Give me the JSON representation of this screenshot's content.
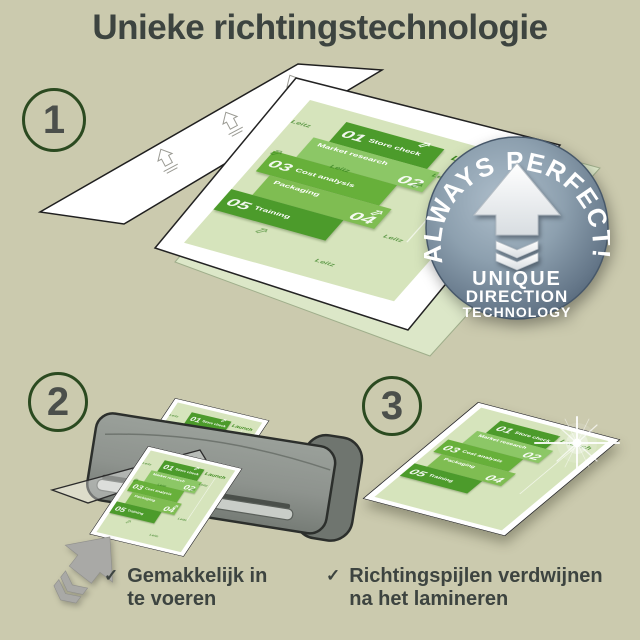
{
  "title": "Unieke richtingstechnologie",
  "steps": {
    "one": "1",
    "two": "2",
    "three": "3"
  },
  "badge": {
    "arc_text": "ALWAYS PERFECT!",
    "line1": "UNIQUE",
    "line2": "DIRECTION",
    "line3": "TECHNOLOGY"
  },
  "doc": {
    "launch_label": "Launch",
    "watermark_brand": "Leitz",
    "arrow_glyph": "⇧",
    "items": [
      {
        "num": "01",
        "label": "Store check"
      },
      {
        "num": "02",
        "label": "Market research"
      },
      {
        "num": "03",
        "label": "Cost analysis"
      },
      {
        "num": "04",
        "label": "Packaging"
      },
      {
        "num": "05",
        "label": "Training"
      }
    ]
  },
  "bullets": [
    {
      "check": "✓",
      "line1": "Gemakkelijk in",
      "line2": "te voeren"
    },
    {
      "check": "✓",
      "line1": "Richtingspijlen verdwijnen",
      "line2": "na het lamineren"
    }
  ],
  "colors": {
    "background": "#cbcaae",
    "ink": "#3d4440",
    "circle_ring": "#2b4a20",
    "green_dark": "#4c9b2b",
    "green_mid": "#67b03a",
    "green_light": "#8cc766",
    "green_light2": "#7fbd52",
    "page_green": "#d6e4bc",
    "launch_green": "#3e8a1e",
    "badge_steel": "#7e93a4",
    "machine_gray": "#8e938e",
    "arrow_gray": "#a9a9a6"
  }
}
